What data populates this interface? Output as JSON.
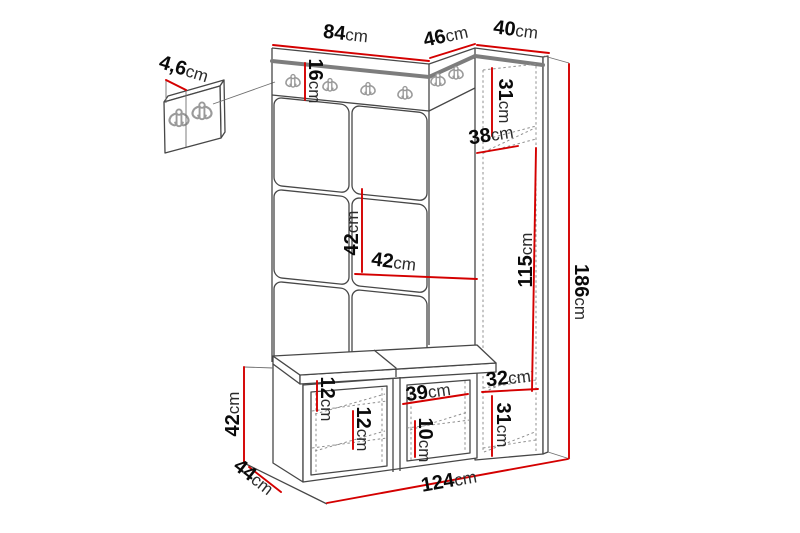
{
  "diagram": {
    "type": "furniture-dimension-drawing",
    "subject": "hallway storage set with panel wall, coat hooks, shoe bench and tall cabinet"
  },
  "colors": {
    "dimension_line": "#d40000",
    "outline": "#474747",
    "rail_edge": "#7d7d7d",
    "hook": "#9a9a9a",
    "background": "#ffffff"
  },
  "icons": {
    "hook": "double-coat-hook-icon"
  },
  "labels": {
    "panel_width": {
      "value": "84",
      "unit": "cm"
    },
    "corner_depth": {
      "value": "46",
      "unit": "cm"
    },
    "cabinet_width": {
      "value": "40",
      "unit": "cm"
    },
    "panel_thickness": {
      "value": "4,6",
      "unit": "cm"
    },
    "rail_height": {
      "value": "16",
      "unit": "cm"
    },
    "cabinet_top_section": {
      "value": "31",
      "unit": "cm"
    },
    "cabinet_shelf_depth": {
      "value": "38",
      "unit": "cm"
    },
    "tile_height": {
      "value": "42",
      "unit": "cm"
    },
    "tile_width": {
      "value": "42",
      "unit": "cm"
    },
    "hanging_height": {
      "value": "115",
      "unit": "cm"
    },
    "total_height": {
      "value": "186",
      "unit": "cm"
    },
    "cabinet_bottom_width": {
      "value": "32",
      "unit": "cm"
    },
    "cabinet_bottom_section": {
      "value": "31",
      "unit": "cm"
    },
    "bench_gap_upper": {
      "value": "12",
      "unit": "cm"
    },
    "bench_gap_lower": {
      "value": "12",
      "unit": "cm"
    },
    "bench_compartment_width": {
      "value": "39",
      "unit": "cm"
    },
    "bench_shelf_spacing": {
      "value": "10",
      "unit": "cm"
    },
    "bench_height": {
      "value": "42",
      "unit": "cm"
    },
    "bench_depth": {
      "value": "44",
      "unit": "cm"
    },
    "total_width": {
      "value": "124",
      "unit": "cm"
    }
  }
}
